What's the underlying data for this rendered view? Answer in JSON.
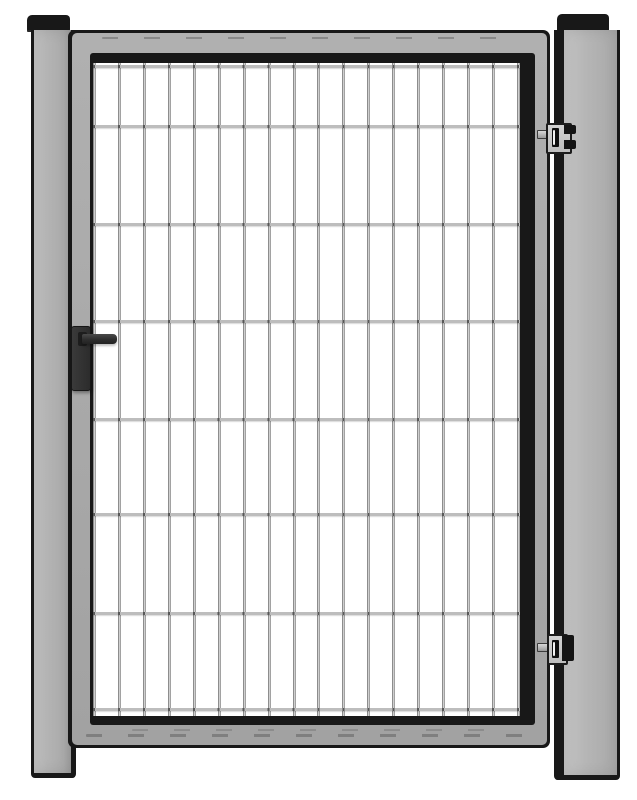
{
  "image": {
    "description": "Catalog illustration of a single-leaf garden gate: a grey steel frame filled with a white welded wire-mesh panel, hung between two grey square posts with flat black caps. A black lock case with a lever handle sits on the left stile; two adjustable hinges with slotted brackets connect the leaf to the right post.",
    "background": "#ffffff"
  },
  "palette": {
    "outline_black": "#181818",
    "post_gray": "#b3b3b3",
    "frame_gray": "#a9a9a9",
    "mesh_white": "#ffffff",
    "wire_light": "#bdbdbd",
    "wire_speck_dark": "#585858",
    "hardware_dark": "#2e2e2e",
    "hinge_plate_gray": "#c8c8c8"
  },
  "components": {
    "left_post": {
      "name": "left post",
      "cap": "flat black cap"
    },
    "right_post": {
      "name": "right hinge post",
      "cap": "flat black cap"
    },
    "gate_leaf": {
      "name": "gate leaf frame with inner shadow edge"
    },
    "mesh": {
      "name": "welded wire mesh infill",
      "vertical_wire_count": 18,
      "horizontal_wire_count": 8,
      "wire_thickness_px": 3,
      "horizontal_wire_offsets_px": [
        2,
        62,
        160,
        257,
        355,
        450,
        549,
        645
      ]
    },
    "lock": {
      "name": "lock case",
      "handle": "lever handle",
      "side": "left stile"
    },
    "hinges": {
      "name": "adjustable slotted hinges",
      "count": 2,
      "side": "right post"
    }
  }
}
